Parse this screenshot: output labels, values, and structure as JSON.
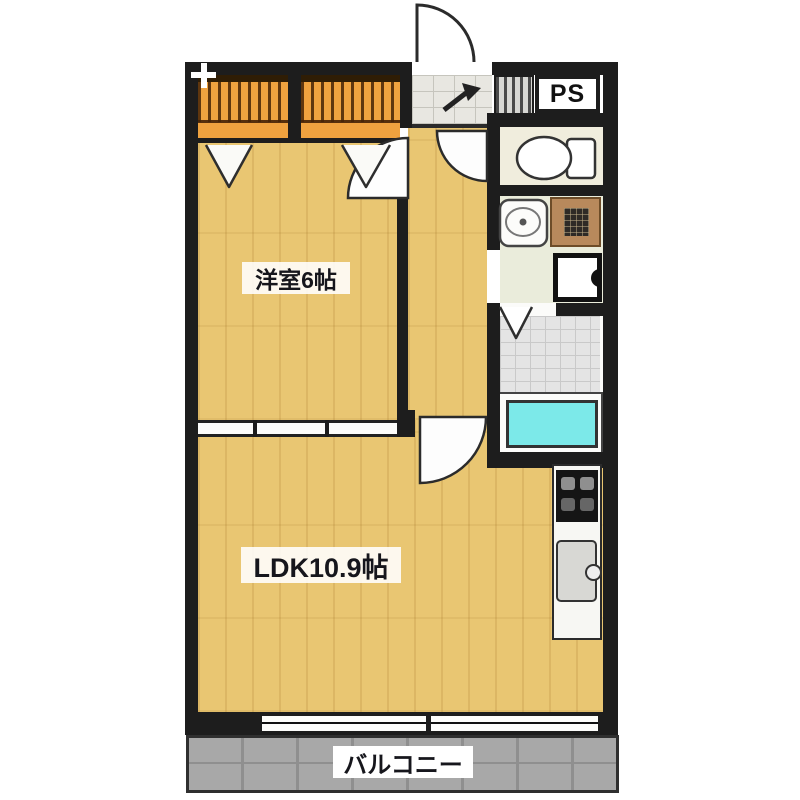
{
  "plan": {
    "type": "apartment-floor-plan",
    "labels": {
      "western_room": "洋室6帖",
      "ldk": "LDK10.9帖",
      "balcony": "バルコニー",
      "pipe_space": "PS"
    },
    "fixtures": {
      "entrance_door": "swing-door",
      "closet_left": "closet-with-hanger-pipe",
      "closet_right": "closet-with-hanger-pipe",
      "toilet": "toilet",
      "washbasin": "washbasin",
      "shelf_box": "shelf",
      "washing_machine_pan": "washing-machine-pan",
      "bathtub": "bathtub",
      "kitchen_stove": "stove",
      "kitchen_sink": "kitchen-sink",
      "ldk_window": "sliding-window"
    },
    "colors": {
      "wall": "#1d1d1d",
      "flooring": "#e9c672",
      "closet": "#efa23f",
      "bathtub": "#7ce9e9",
      "bathroom_tile": "#e4e4e4",
      "washroom_floor": "#eaecdb",
      "toilet_floor": "#f0eddd",
      "genkan_tile": "#e8e7e1",
      "balcony": "#a8a8a8",
      "background": "#ffffff"
    }
  }
}
